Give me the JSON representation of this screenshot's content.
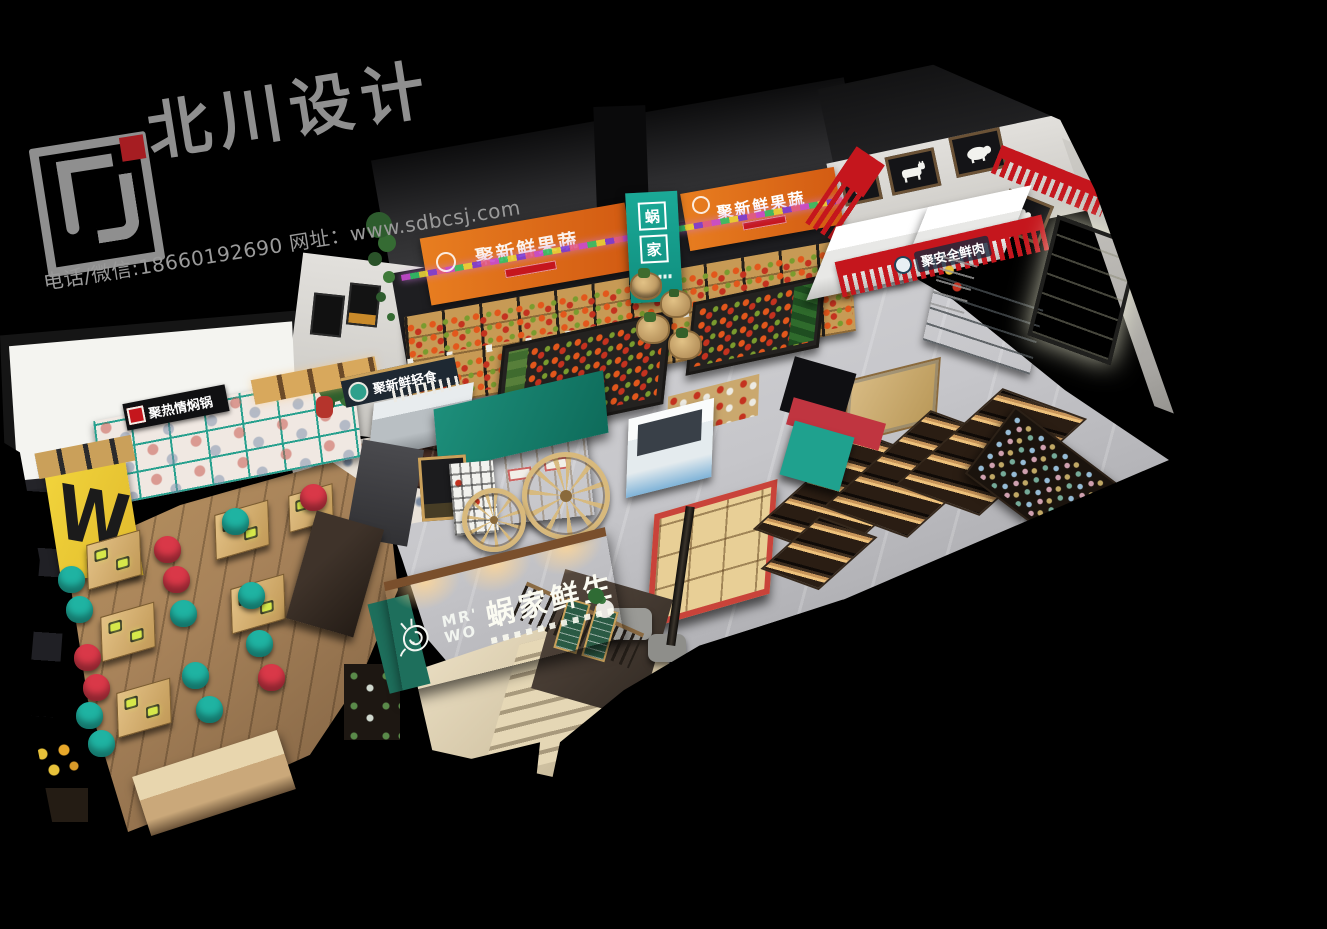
{
  "watermark": {
    "brand": "北川设计",
    "contact": "电话/微信:18660192690 网址：www.sdbcsj.com"
  },
  "storefront": {
    "name": "蜗家鲜生",
    "latin_line1": "MR'",
    "latin_line2": "WO"
  },
  "entry_column": {
    "char_top": "蜗",
    "char_bottom": "家"
  },
  "banners": {
    "fruit_left": "聚新鲜果蔬",
    "fruit_right": "聚新鲜果蔬",
    "meat": "聚安全鲜肉",
    "deli": "聚新鲜轻食",
    "hotpot": "聚热情焖锅"
  },
  "hotpot_art_letter": "W",
  "colors": {
    "fruit_banner_orange": "#df6f1f",
    "entry_column_teal": "#18a392",
    "meat_banner_red": "#c5161d",
    "storefront_green": "#2f9579",
    "chair_teal": "#1fb3a2",
    "chair_red": "#d93848",
    "cart_canopy_teal": "#14826f",
    "watermark_gray": "#8f8f8f",
    "logo_accent_red": "#a61d22"
  }
}
